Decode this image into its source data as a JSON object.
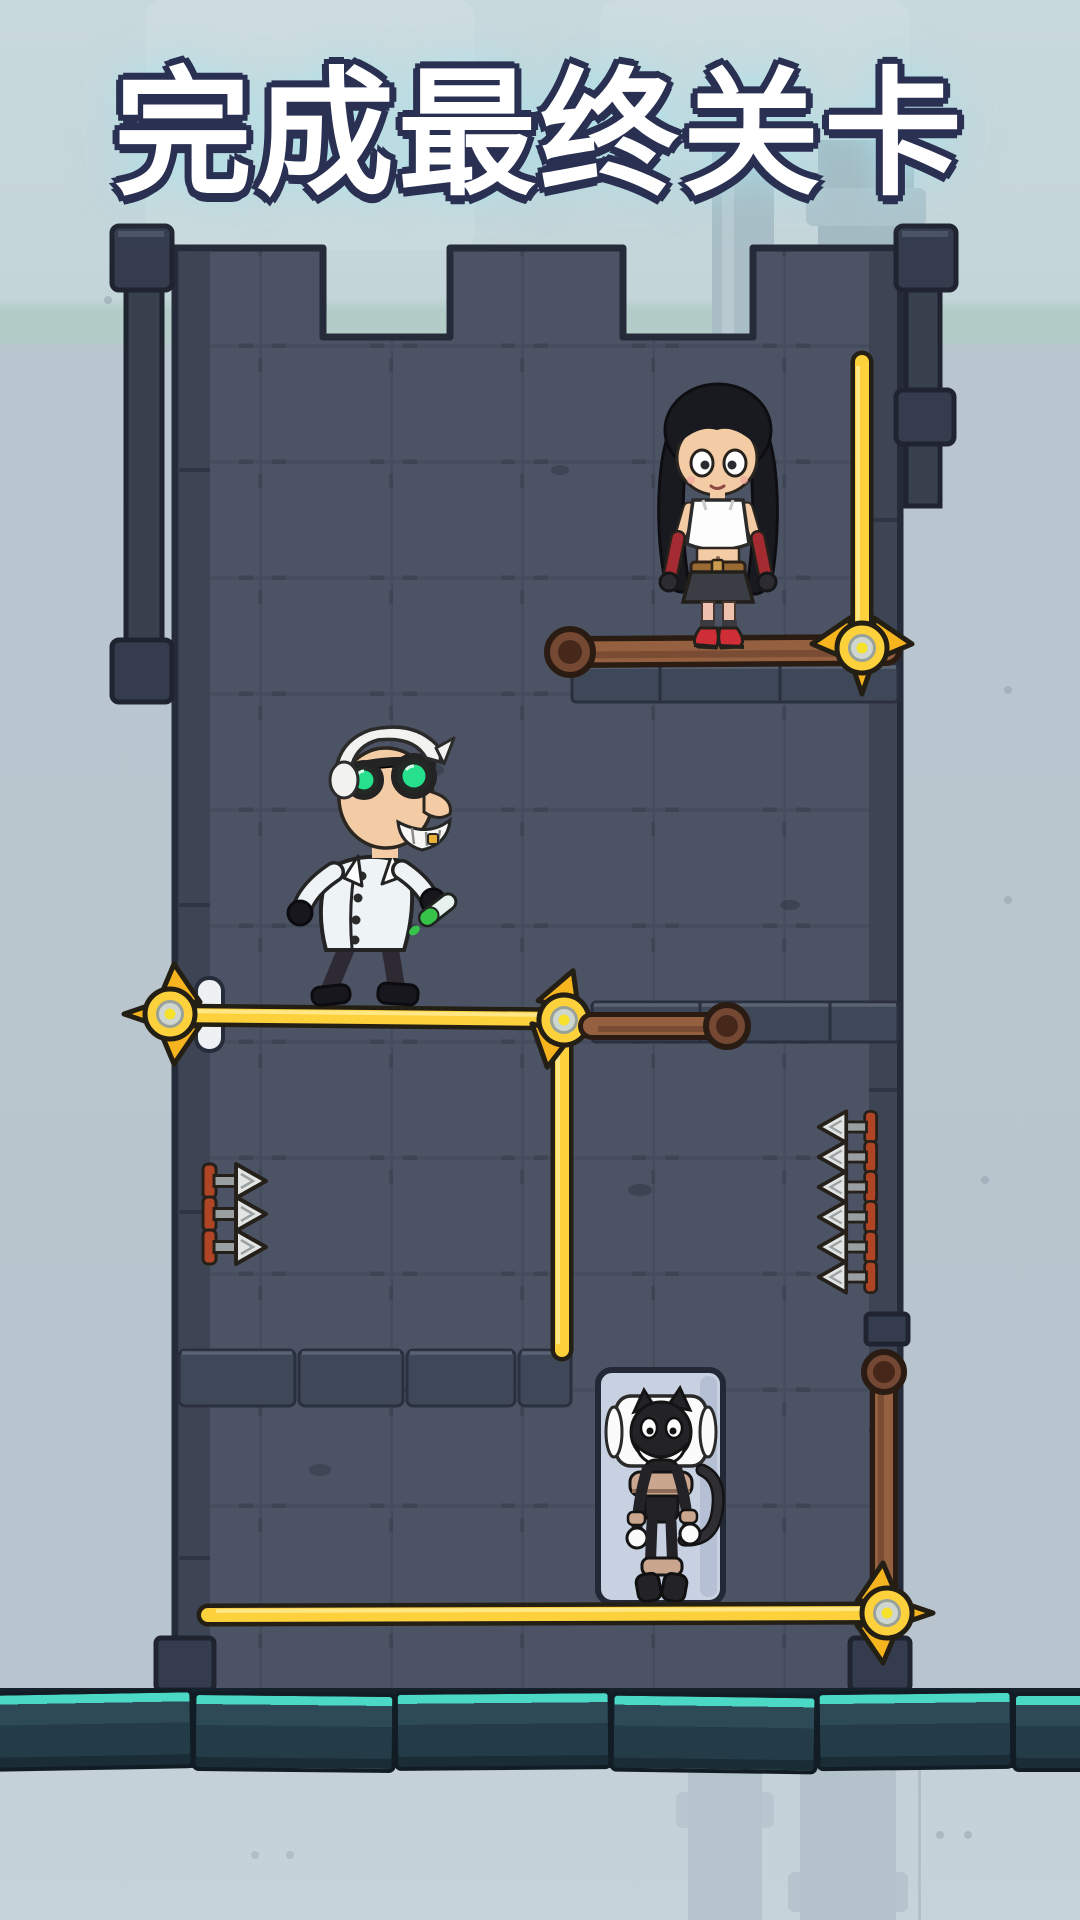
{
  "title": {
    "text": "完成最终关卡"
  },
  "scene": {
    "description": "pin-pull rescue puzzle level inside a castle tower",
    "characters": [
      {
        "id": "girl",
        "label": "girl with black hair, white tank top, black skirt, red boots",
        "position": "upper right, standing on brown bar"
      },
      {
        "id": "scientist",
        "label": "mad scientist with green goggles holding green vial",
        "position": "middle left, standing on gold pin bar"
      },
      {
        "id": "cat",
        "label": "black cartoon cat lying strapped in a light box",
        "position": "lower middle"
      }
    ],
    "pins": [
      {
        "id": "pin-top-right",
        "shape": "vertical gold pin",
        "head": "down at right side under girl platform"
      },
      {
        "id": "pin-middle",
        "shape": "L-shaped gold pin, horizontal bar with left head and vertical drop shaft"
      },
      {
        "id": "pin-bottom",
        "shape": "long horizontal gold pin, head at right through hanging brown bar"
      }
    ],
    "bars": [
      {
        "id": "girl-platform",
        "type": "brown rod with round left cap",
        "holds": "girl"
      },
      {
        "id": "mid-right-rod",
        "type": "short brown rod with round right cap"
      },
      {
        "id": "right-hanging-rod",
        "type": "vertical brown rod with round top cap, pinned at bottom"
      }
    ],
    "hazards": {
      "left_spikes_count": 3,
      "right_spikes_count": 6,
      "spike_type": "silver arrow spikes on wall"
    },
    "objects": [
      {
        "id": "pin-slot",
        "label": "white pin socket on left wall"
      },
      {
        "id": "cat-box",
        "label": "light rounded box containing the cat, resting on bottom pin"
      }
    ],
    "colors": {
      "gold_pin": "#fdd13c",
      "pin_barb": "#f6b41f",
      "brown_bar": "#946040",
      "wall": "#4b5364",
      "wall_border": "#3a4252",
      "background": "#bac6cf",
      "floor_highlight": "#4bd9c6",
      "floor_face": "#23404c",
      "spike_base": "#b04526",
      "goggle_lens": "#27e08c",
      "boot_red": "#cf2e36",
      "title_fill": "#ffffff",
      "title_outline": "#2a3052"
    }
  }
}
